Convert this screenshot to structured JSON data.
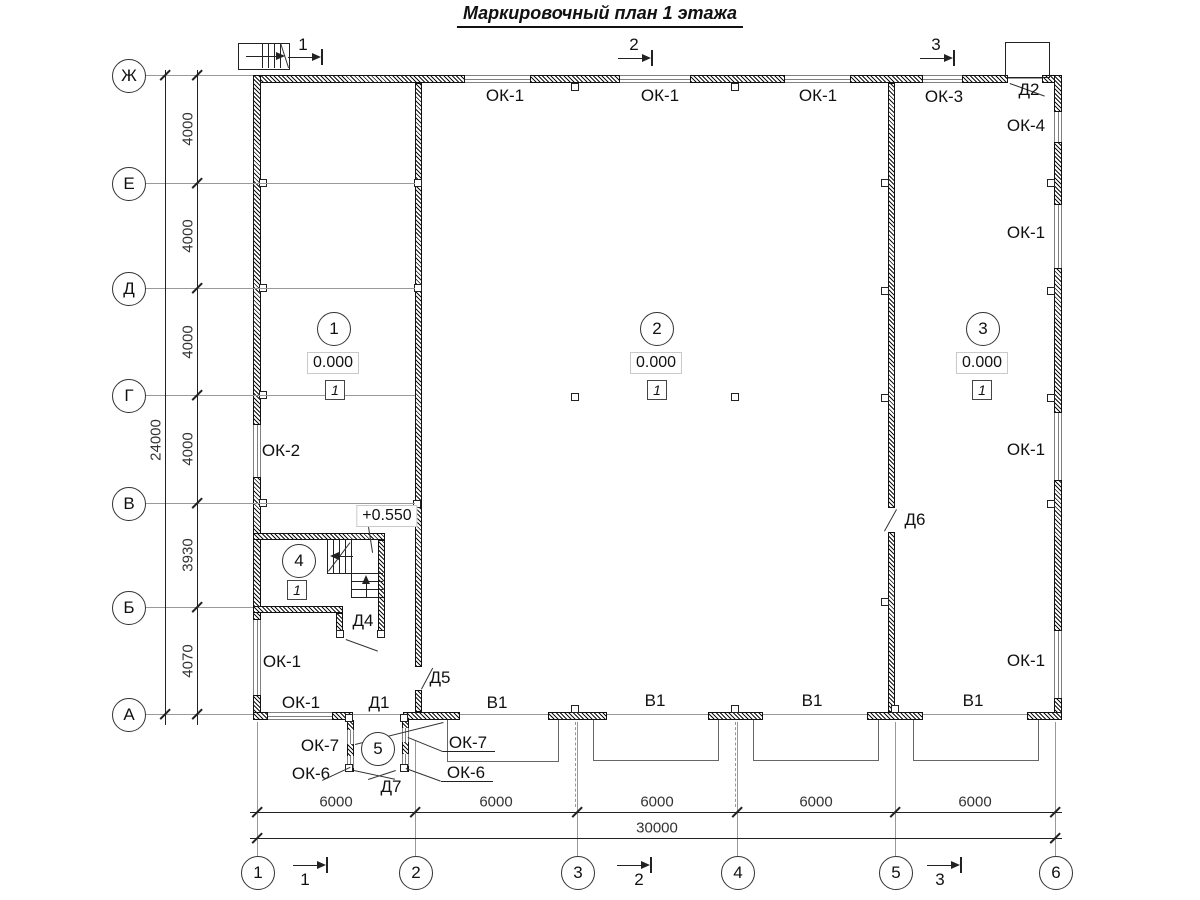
{
  "title": "Маркировочный план 1 этажа",
  "grid": {
    "rows": [
      "Ж",
      "Е",
      "Д",
      "Г",
      "В",
      "Б",
      "А"
    ],
    "cols": [
      "1",
      "2",
      "3",
      "4",
      "5",
      "6"
    ],
    "row_dims": [
      "4000",
      "4000",
      "4000",
      "4000",
      "3930",
      "4070"
    ],
    "row_total": "24000",
    "col_dims": [
      "6000",
      "6000",
      "6000",
      "6000",
      "6000"
    ],
    "col_total": "30000"
  },
  "sections": {
    "top": [
      "1",
      "2",
      "3"
    ],
    "bottom": [
      "1",
      "2",
      "3"
    ]
  },
  "rooms": {
    "r1": {
      "num": "1",
      "elev": "0.000",
      "finish": "1"
    },
    "r2": {
      "num": "2",
      "elev": "0.000",
      "finish": "1"
    },
    "r3": {
      "num": "3",
      "elev": "0.000",
      "finish": "1"
    },
    "r4": {
      "num": "4",
      "finish": "1"
    },
    "r5": {
      "num": "5"
    }
  },
  "levels": {
    "stair_landing": "+0.550"
  },
  "openings": {
    "top_windows": [
      "ОК-1",
      "ОК-1",
      "ОК-1",
      "ОК-3"
    ],
    "right_windows": [
      "ОК-4",
      "ОК-1",
      "ОК-1",
      "ОК-1"
    ],
    "left_windows": [
      "ОК-2",
      "ОК-1"
    ],
    "bottom_window": "ОК-1",
    "gates": [
      "В1",
      "В1",
      "В1",
      "В1"
    ],
    "vestibule_windows": [
      "ОК-7",
      "ОК-7",
      "ОК-6",
      "ОК-6"
    ],
    "doors": {
      "d1": "Д1",
      "d2": "Д2",
      "d4": "Д4",
      "d5": "Д5",
      "d6": "Д6",
      "d7": "Д7"
    }
  }
}
